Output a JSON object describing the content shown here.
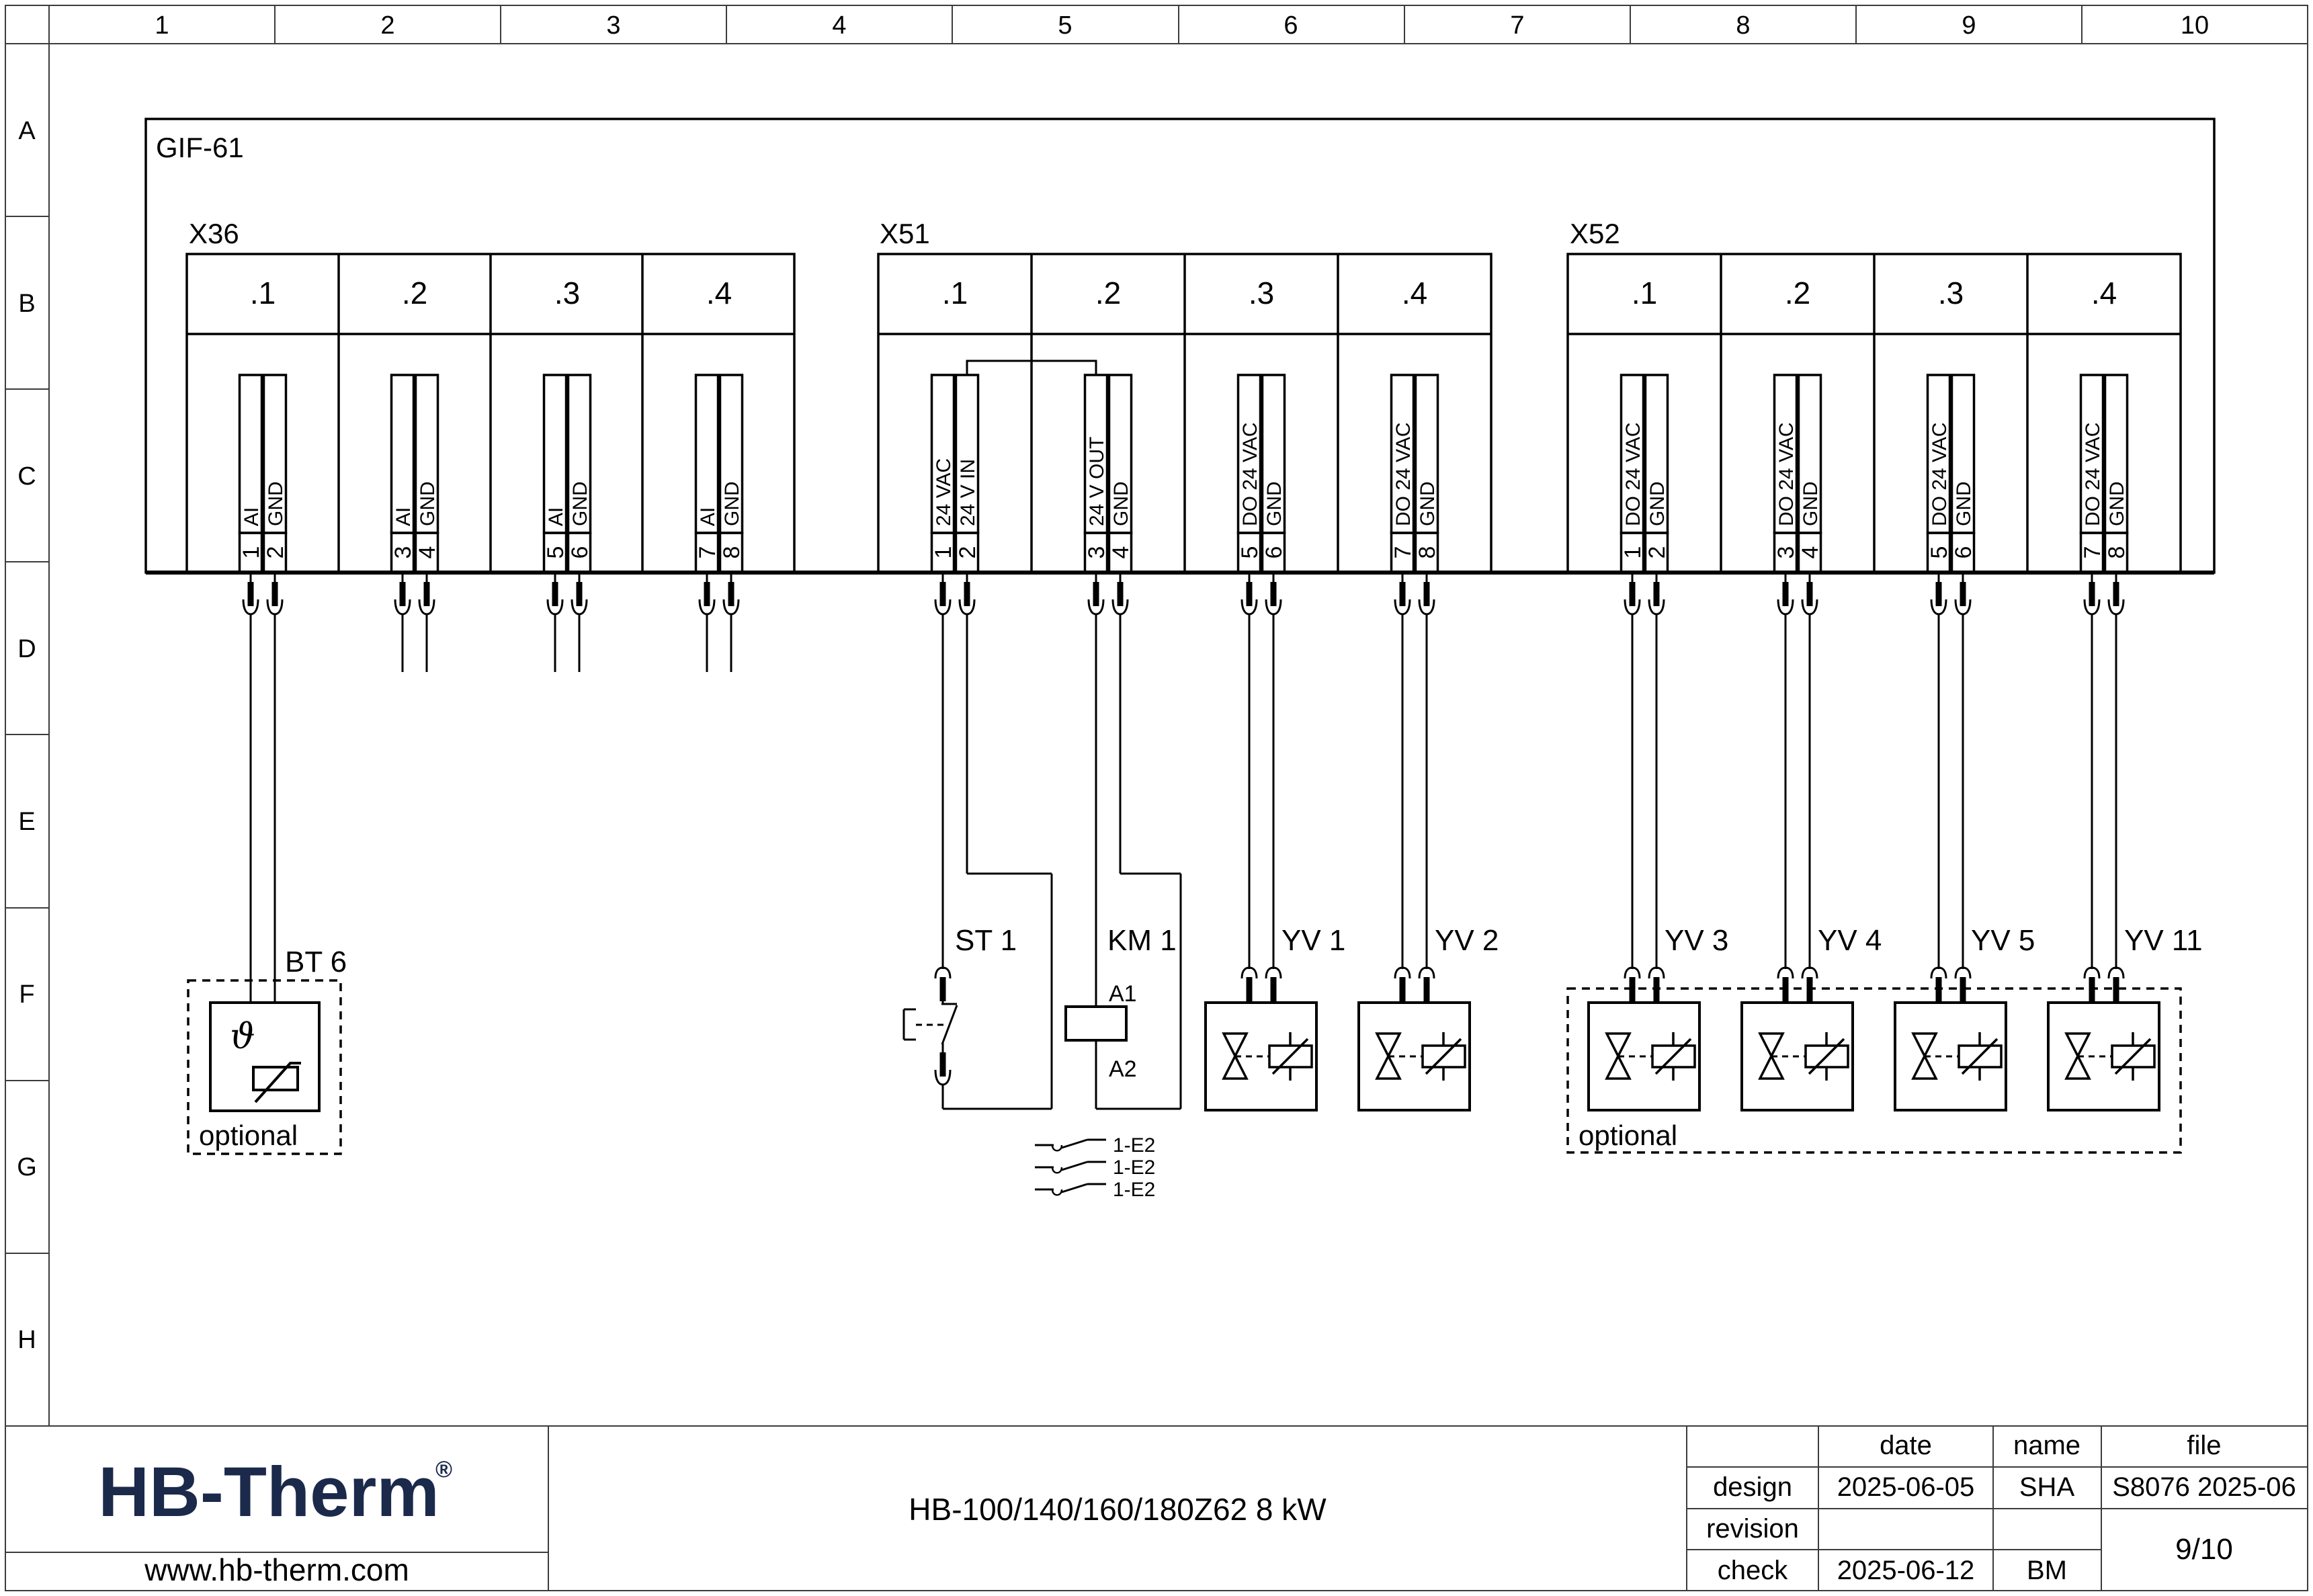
{
  "frame": {
    "columns": [
      "1",
      "2",
      "3",
      "4",
      "5",
      "6",
      "7",
      "8",
      "9",
      "10"
    ],
    "rows": [
      "A",
      "B",
      "C",
      "D",
      "E",
      "F",
      "G",
      "H"
    ]
  },
  "diagram": {
    "main_block_label": "GIF-61",
    "optional_left": "optional",
    "optional_right": "optional",
    "blocks": {
      "x36": {
        "label": "X36",
        "sections": [
          ".1",
          ".2",
          ".3",
          ".4"
        ],
        "pins": [
          {
            "no": "1",
            "name": "AI"
          },
          {
            "no": "2",
            "name": "GND"
          },
          {
            "no": "3",
            "name": "AI"
          },
          {
            "no": "4",
            "name": "GND"
          },
          {
            "no": "5",
            "name": "AI"
          },
          {
            "no": "6",
            "name": "GND"
          },
          {
            "no": "7",
            "name": "AI"
          },
          {
            "no": "8",
            "name": "GND"
          }
        ]
      },
      "x51": {
        "label": "X51",
        "sections": [
          ".1",
          ".2",
          ".3",
          ".4"
        ],
        "pins": [
          {
            "no": "1",
            "name": "24 VAC"
          },
          {
            "no": "2",
            "name": "24 V IN"
          },
          {
            "no": "3",
            "name": "24 V OUT"
          },
          {
            "no": "4",
            "name": "GND"
          },
          {
            "no": "5",
            "name": "DO 24 VAC"
          },
          {
            "no": "6",
            "name": "GND"
          },
          {
            "no": "7",
            "name": "DO 24 VAC"
          },
          {
            "no": "8",
            "name": "GND"
          }
        ]
      },
      "x52": {
        "label": "X52",
        "sections": [
          ".1",
          ".2",
          ".3",
          ".4"
        ],
        "pins": [
          {
            "no": "1",
            "name": "DO 24 VAC"
          },
          {
            "no": "2",
            "name": "GND"
          },
          {
            "no": "3",
            "name": "DO 24 VAC"
          },
          {
            "no": "4",
            "name": "GND"
          },
          {
            "no": "5",
            "name": "DO 24 VAC"
          },
          {
            "no": "6",
            "name": "GND"
          },
          {
            "no": "7",
            "name": "DO 24 VAC"
          },
          {
            "no": "8",
            "name": "GND"
          }
        ]
      }
    },
    "components": {
      "bt6": {
        "label": "BT 6",
        "symbol": "ϑ"
      },
      "st1": {
        "label": "ST 1"
      },
      "km1": {
        "label": "KM 1",
        "a1": "A1",
        "a2": "A2"
      },
      "yv1": {
        "label": "YV 1"
      },
      "yv2": {
        "label": "YV 2"
      },
      "yv3": {
        "label": "YV 3"
      },
      "yv4": {
        "label": "YV 4"
      },
      "yv5": {
        "label": "YV 5"
      },
      "yv11": {
        "label": "YV 11"
      },
      "aux_contacts": [
        {
          "label": "1-E2"
        },
        {
          "label": "1-E2"
        },
        {
          "label": "1-E2"
        }
      ]
    }
  },
  "title_block": {
    "logo_text": "HB-Therm",
    "logo_reg": "®",
    "logo_color": "#1b294a",
    "website": "www.hb-therm.com",
    "doc_title": "HB-100/140/160/180Z62 8 kW",
    "table": {
      "headers": {
        "date": "date",
        "name": "name",
        "file": "file"
      },
      "design": {
        "label": "design",
        "date": "2025-06-05",
        "name": "SHA",
        "file": "S8076 2025-06"
      },
      "revision": {
        "label": "revision"
      },
      "check": {
        "label": "check",
        "date": "2025-06-12",
        "name": "BM"
      },
      "page": "9/10"
    }
  }
}
